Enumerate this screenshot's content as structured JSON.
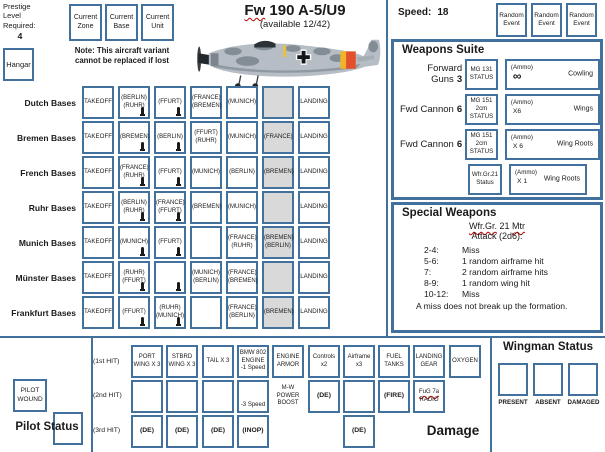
{
  "colors": {
    "accent_blue": "#41719c",
    "gray_fill": "#d9d9d9",
    "squiggle_red": "#c00000"
  },
  "header": {
    "prestige_label": "Prestige\nLevel\nRequired:",
    "prestige_value": "4",
    "current_boxes": [
      {
        "name": "current-zone-box",
        "label": "Current Zone"
      },
      {
        "name": "current-base-box",
        "label": "Current Base"
      },
      {
        "name": "current-unit-box",
        "label": "Current Unit"
      }
    ],
    "title_parts": [
      {
        "t": "Fw",
        "sq": true
      },
      {
        "t": " 190 A-5/U9",
        "sq": false
      }
    ],
    "subtitle": "(available 12/42)",
    "speed_label": "Speed:",
    "speed_value": "18",
    "random_event_boxes": [
      "Random Event",
      "Random Event",
      "Random Event"
    ],
    "hangar_label": "Hangar",
    "note": "Note: This aircraft variant\ncannot be replaced if lost",
    "aircraft_image": "Fw 190 side profile illustration"
  },
  "bases": {
    "takeoff_label": "TAKEOFF",
    "landing_label": "LANDING",
    "track_marker_icon": "bomb-icon",
    "rows": [
      {
        "label": "Dutch Bases",
        "cells": [
          {
            "lines": [
              "(BERLIN)",
              "(RUHR)"
            ],
            "bomb": true
          },
          {
            "lines": [
              "(FFURT)"
            ],
            "bomb": true
          },
          {
            "lines": [
              "(FRANCE)",
              "(BREMEN)"
            ]
          },
          {
            "lines": [
              "(MUNICH)"
            ]
          },
          {
            "lines": [],
            "gray": true
          }
        ]
      },
      {
        "label": "Bremen Bases",
        "cells": [
          {
            "lines": [
              "(BREMEN)"
            ],
            "bomb": true
          },
          {
            "lines": [
              "(BERLIN)"
            ],
            "bomb": true
          },
          {
            "lines": [
              "(FFURT)",
              "(RUHR)"
            ]
          },
          {
            "lines": [
              "(MUNICH)"
            ]
          },
          {
            "lines": [
              "(FRANCE)"
            ],
            "gray": true
          }
        ]
      },
      {
        "label": "French Bases",
        "cells": [
          {
            "lines": [
              "(FRANCE)",
              "(RUHR)"
            ],
            "bomb": true
          },
          {
            "lines": [
              "(FFURT)"
            ],
            "bomb": true
          },
          {
            "lines": [
              "(MUNICH)"
            ]
          },
          {
            "lines": [
              "(BERLIN)"
            ]
          },
          {
            "lines": [
              "(BREMEN)"
            ],
            "gray": true
          }
        ]
      },
      {
        "label": "Ruhr Bases",
        "cells": [
          {
            "lines": [
              "(BERLIN)",
              "(RUHR)"
            ],
            "bomb": true
          },
          {
            "lines": [
              "(FRANCE)",
              "(FFURT)"
            ],
            "bomb": true
          },
          {
            "lines": [
              "(BREMEN)"
            ]
          },
          {
            "lines": [
              "(MUNICH)"
            ]
          },
          {
            "lines": [],
            "gray": true
          }
        ]
      },
      {
        "label": "Munich Bases",
        "cells": [
          {
            "lines": [
              "(MUNICH)"
            ],
            "bomb": true
          },
          {
            "lines": [
              "(FFURT)"
            ],
            "bomb": true
          },
          {
            "lines": []
          },
          {
            "lines": [
              "(FRANCE)",
              "(RUHR)"
            ]
          },
          {
            "lines": [
              "(BREMEN)",
              "(BERLIN)"
            ],
            "gray": true
          }
        ]
      },
      {
        "label": "Münster Bases",
        "cells": [
          {
            "lines": [
              "(RUHR)",
              "(FFURT)"
            ],
            "bomb": true
          },
          {
            "lines": [],
            "bomb": true
          },
          {
            "lines": [
              "(MUNICH)",
              "(BERLIN)"
            ]
          },
          {
            "lines": [
              "(FRANCE)",
              "(BREMEN)"
            ]
          },
          {
            "lines": [],
            "gray": true
          }
        ]
      },
      {
        "label": "Frankfurt Bases",
        "cells": [
          {
            "lines": [
              "(FFURT)"
            ],
            "bomb": true
          },
          {
            "lines": [
              "(RUHR)",
              "(MUNICH)"
            ],
            "bomb": true
          },
          {
            "lines": []
          },
          {
            "lines": [
              "(FRANCE)",
              "(BERLIN)"
            ]
          },
          {
            "lines": [
              "(BREMEN)"
            ],
            "gray": true
          }
        ]
      }
    ]
  },
  "weapons_suite": {
    "title": "Weapons Suite",
    "rows": [
      {
        "gun_label": "Forward Guns",
        "gun_value": "3",
        "status": [
          "MG 131",
          "STATUS"
        ],
        "ammo_label": "(Ammo)",
        "ammo_value": "∞",
        "location": "Cowling"
      },
      {
        "gun_label": "Fwd Cannon",
        "gun_value": "6",
        "status": [
          "MG 151",
          "2cm",
          "STATUS"
        ],
        "ammo_label": "(Ammo)",
        "ammo_value": "X6",
        "location": "Wings"
      },
      {
        "gun_label": "Fwd Cannon",
        "gun_value": "6",
        "status": [
          "MG 151",
          "2cm",
          "STATUS"
        ],
        "ammo_label": "(Ammo)",
        "ammo_value": "X 6",
        "location": "Wing Roots"
      },
      {
        "gun_label": "",
        "gun_value": "",
        "status": [
          "Wfr.Gr.21",
          "Status"
        ],
        "ammo_label": "(Ammo)",
        "ammo_value": "X 1",
        "location": "Wing Roots",
        "narrow": true
      }
    ]
  },
  "special_weapons": {
    "title": "Special Weapons",
    "name_parts": [
      {
        "t": "Wfr.Gr.",
        "sq": true
      },
      {
        "t": " 21 ",
        "sq": false
      },
      {
        "t": "Mtr",
        "sq": true
      }
    ],
    "attack_label": "Attack (2d6):",
    "table": [
      {
        "roll": "2-4:",
        "result": "Miss"
      },
      {
        "roll": "5-6:",
        "result": "1 random airframe hit"
      },
      {
        "roll": "7:",
        "result": "2 random airframe hits"
      },
      {
        "roll": "8-9:",
        "result": "1 random wing hit"
      },
      {
        "roll": "10-12:",
        "result": "Miss"
      }
    ],
    "footnote": "A miss does not break up the formation."
  },
  "pilot": {
    "wound_box_label": "PILOT\nWOUND",
    "status_title": "Pilot Status"
  },
  "damage": {
    "row_labels": [
      "(1st  HIT)",
      "(2nd  HIT)",
      "(3rd  HIT)"
    ],
    "section_label": "Damage",
    "columns": [
      {
        "name": "port-wing",
        "hit1": [
          "PORT",
          "WING X 3"
        ],
        "hit2": {
          "box": true,
          "lines": []
        },
        "hit3": {
          "text": "(DE)"
        }
      },
      {
        "name": "stbrd-wing",
        "hit1": [
          "STBRD",
          "WING X 3"
        ],
        "hit2": {
          "box": true,
          "lines": []
        },
        "hit3": {
          "text": "(DE)"
        }
      },
      {
        "name": "tail",
        "hit1": [
          "TAIL X 3"
        ],
        "hit2": {
          "box": true,
          "lines": []
        },
        "hit3": {
          "text": "(DE)"
        }
      },
      {
        "name": "engine",
        "hit1": [
          "BMW 802",
          "ENGINE",
          "-1 Speed"
        ],
        "hit2": {
          "box": true,
          "lines": [
            "-3 Speed"
          ],
          "align": "bottom"
        },
        "hit3": {
          "text": "(INOP)"
        }
      },
      {
        "name": "engine-armor",
        "hit1": [
          "ENGINE",
          "ARMOR"
        ],
        "hit2": {
          "box": false,
          "lines": [
            "M-W",
            "POWER",
            "BOOST"
          ]
        },
        "hit3": null
      },
      {
        "name": "controls",
        "hit1": [
          "Controls",
          "x2"
        ],
        "hit2": {
          "box": true,
          "lines": [
            "(DE)"
          ],
          "bold": true
        },
        "hit3": null
      },
      {
        "name": "airframe",
        "hit1": [
          "Airframe",
          "x3"
        ],
        "hit2": {
          "box": true,
          "lines": []
        },
        "hit3": {
          "text": "(DE)"
        }
      },
      {
        "name": "fuel-tanks",
        "hit1": [
          "FUEL",
          "TANKS"
        ],
        "hit2": {
          "box": true,
          "lines": [
            "(FIRE)"
          ],
          "bold": true
        },
        "hit3": null
      },
      {
        "name": "landing-gear",
        "hit1": [
          "LANDING",
          "GEAR"
        ],
        "hit2": {
          "box": true,
          "lines": [
            "FuG 7a",
            "RADIO"
          ],
          "squig_first": true
        },
        "hit3": null
      },
      {
        "name": "oxygen",
        "hit1": [
          "OXYGEN"
        ],
        "hit2": null,
        "hit3": null
      }
    ]
  },
  "wingman": {
    "title": "Wingman Status",
    "states": [
      "PRESENT",
      "ABSENT",
      "DAMAGED"
    ]
  }
}
